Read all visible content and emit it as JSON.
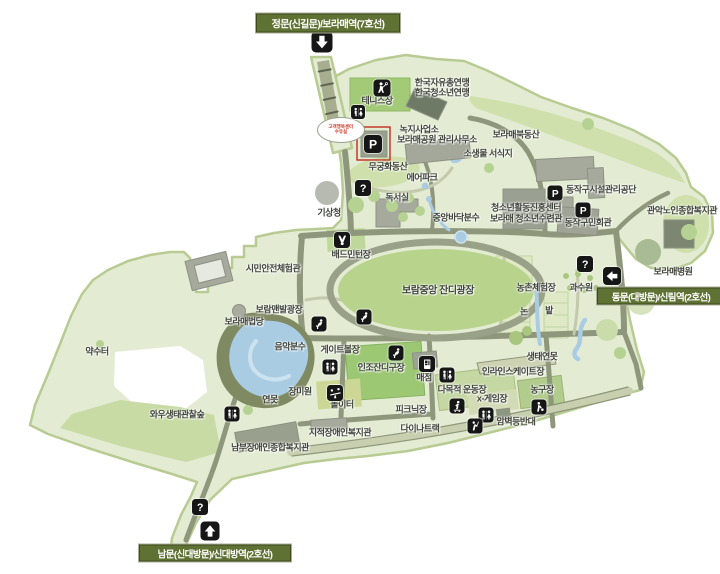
{
  "gates": [
    {
      "id": "north",
      "label": "정문(신길문)/보라매역(7호선)"
    },
    {
      "id": "east",
      "label": "동문(대방문)/신림역(2호선)"
    },
    {
      "id": "south",
      "label": "남문(신대방문)/신대방역(2호선)"
    }
  ],
  "bubble": {
    "line1": "고객행복센터",
    "line2": "수유실"
  },
  "labels": [
    {
      "t": "한국자유총연맹",
      "x": 442,
      "y": 82
    },
    {
      "t": "한국청소년연맹",
      "x": 442,
      "y": 92
    },
    {
      "t": "테니스장",
      "x": 377,
      "y": 100
    },
    {
      "t": "녹지사업소",
      "x": 419,
      "y": 129
    },
    {
      "t": "보라매공원 관리사무소",
      "x": 437,
      "y": 139
    },
    {
      "t": "보라매북동산",
      "x": 516,
      "y": 134
    },
    {
      "t": "소생물 서식지",
      "x": 488,
      "y": 153
    },
    {
      "t": "무궁화동산",
      "x": 388,
      "y": 166
    },
    {
      "t": "에어파크",
      "x": 422,
      "y": 177
    },
    {
      "t": "독서실",
      "x": 397,
      "y": 197
    },
    {
      "t": "기상청",
      "x": 329,
      "y": 212
    },
    {
      "t": "중앙바닥분수",
      "x": 456,
      "y": 217
    },
    {
      "t": "청소년활동진흥센터",
      "x": 526,
      "y": 207
    },
    {
      "t": "보라매 청소년수련관",
      "x": 526,
      "y": 218
    },
    {
      "t": "동작구시설관리공단",
      "x": 601,
      "y": 189
    },
    {
      "t": "동작구민회관",
      "x": 588,
      "y": 222
    },
    {
      "t": "관악노인종합복지관",
      "x": 682,
      "y": 210
    },
    {
      "t": "보라매병원",
      "x": 673,
      "y": 271
    },
    {
      "t": "시민안전체험관",
      "x": 273,
      "y": 268
    },
    {
      "t": "배드민턴장",
      "x": 351,
      "y": 254
    },
    {
      "t": "보람중앙 잔디광장",
      "x": 438,
      "y": 289,
      "fs": 10
    },
    {
      "t": "농촌체험장",
      "x": 536,
      "y": 287
    },
    {
      "t": "과수원",
      "x": 581,
      "y": 287
    },
    {
      "t": "논",
      "x": 524,
      "y": 311
    },
    {
      "t": "밭",
      "x": 549,
      "y": 310
    },
    {
      "t": "보람맨발광장",
      "x": 279,
      "y": 309
    },
    {
      "t": "보라매법당",
      "x": 244,
      "y": 321
    },
    {
      "t": "음악분수",
      "x": 290,
      "y": 346
    },
    {
      "t": "게이트볼장",
      "x": 340,
      "y": 349
    },
    {
      "t": "인조잔디구장",
      "x": 381,
      "y": 367
    },
    {
      "t": "약수터",
      "x": 97,
      "y": 351
    },
    {
      "t": "와우생태관찰숲",
      "x": 177,
      "y": 414
    },
    {
      "t": "연못",
      "x": 270,
      "y": 399
    },
    {
      "t": "장미원",
      "x": 300,
      "y": 391
    },
    {
      "t": "놀이터",
      "x": 342,
      "y": 404
    },
    {
      "t": "피크닉장",
      "x": 411,
      "y": 409
    },
    {
      "t": "매점",
      "x": 424,
      "y": 377
    },
    {
      "t": "다목적 운동장",
      "x": 462,
      "y": 389
    },
    {
      "t": "x-게임장",
      "x": 492,
      "y": 398
    },
    {
      "t": "인라인스케이트장",
      "x": 513,
      "y": 371
    },
    {
      "t": "생태연못",
      "x": 542,
      "y": 356
    },
    {
      "t": "농구장",
      "x": 542,
      "y": 389
    },
    {
      "t": "암벽등반대",
      "x": 516,
      "y": 421
    },
    {
      "t": "다이나트랙",
      "x": 420,
      "y": 428
    },
    {
      "t": "지적장애인복지관",
      "x": 340,
      "y": 432
    },
    {
      "t": "남부장애인종합복지관",
      "x": 270,
      "y": 447
    }
  ],
  "icons": [
    {
      "t": "arrow-down",
      "x": 322,
      "y": 42,
      "s": 21
    },
    {
      "t": "tennis",
      "x": 382,
      "y": 88,
      "s": 17
    },
    {
      "t": "restroom",
      "x": 358,
      "y": 112,
      "s": 14
    },
    {
      "t": "parking",
      "x": 373,
      "y": 144,
      "s": 18
    },
    {
      "t": "info",
      "x": 363,
      "y": 188,
      "s": 16
    },
    {
      "t": "parking",
      "x": 555,
      "y": 193,
      "s": 15
    },
    {
      "t": "parking",
      "x": 583,
      "y": 210,
      "s": 15
    },
    {
      "t": "info",
      "x": 585,
      "y": 264,
      "s": 16
    },
    {
      "t": "arrow-left",
      "x": 612,
      "y": 276,
      "s": 18
    },
    {
      "t": "badminton",
      "x": 342,
      "y": 240,
      "s": 16
    },
    {
      "t": "drinking-fountain",
      "x": 319,
      "y": 324,
      "s": 15
    },
    {
      "t": "drinking-fountain",
      "x": 364,
      "y": 317,
      "s": 15
    },
    {
      "t": "drinking-fountain",
      "x": 396,
      "y": 353,
      "s": 15
    },
    {
      "t": "restroom",
      "x": 330,
      "y": 367,
      "s": 15
    },
    {
      "t": "restroom",
      "x": 232,
      "y": 414,
      "s": 15
    },
    {
      "t": "playground",
      "x": 335,
      "y": 393,
      "s": 16
    },
    {
      "t": "shop",
      "x": 427,
      "y": 364,
      "s": 16
    },
    {
      "t": "restroom",
      "x": 447,
      "y": 375,
      "s": 15
    },
    {
      "t": "inline-skate",
      "x": 457,
      "y": 406,
      "s": 15
    },
    {
      "t": "restroom",
      "x": 486,
      "y": 415,
      "s": 15
    },
    {
      "t": "climbing",
      "x": 475,
      "y": 426,
      "s": 15
    },
    {
      "t": "basketball",
      "x": 539,
      "y": 407,
      "s": 15
    },
    {
      "t": "info",
      "x": 200,
      "y": 507,
      "s": 16
    },
    {
      "t": "arrow-up",
      "x": 210,
      "y": 531,
      "s": 19
    }
  ],
  "colors": {
    "park_fill": "#e3ecd3",
    "park_border": "#b7cb92",
    "road": "#8e967b",
    "water": "#a9cce3",
    "lawn": "#b7d38c",
    "badge_bg": "#5f7233",
    "badge_text": "#ffffff",
    "icon_bg": "#161616",
    "highlight_red": "#c5392b",
    "label_text": "#40453c",
    "bubble_text": "#d03a2a"
  }
}
